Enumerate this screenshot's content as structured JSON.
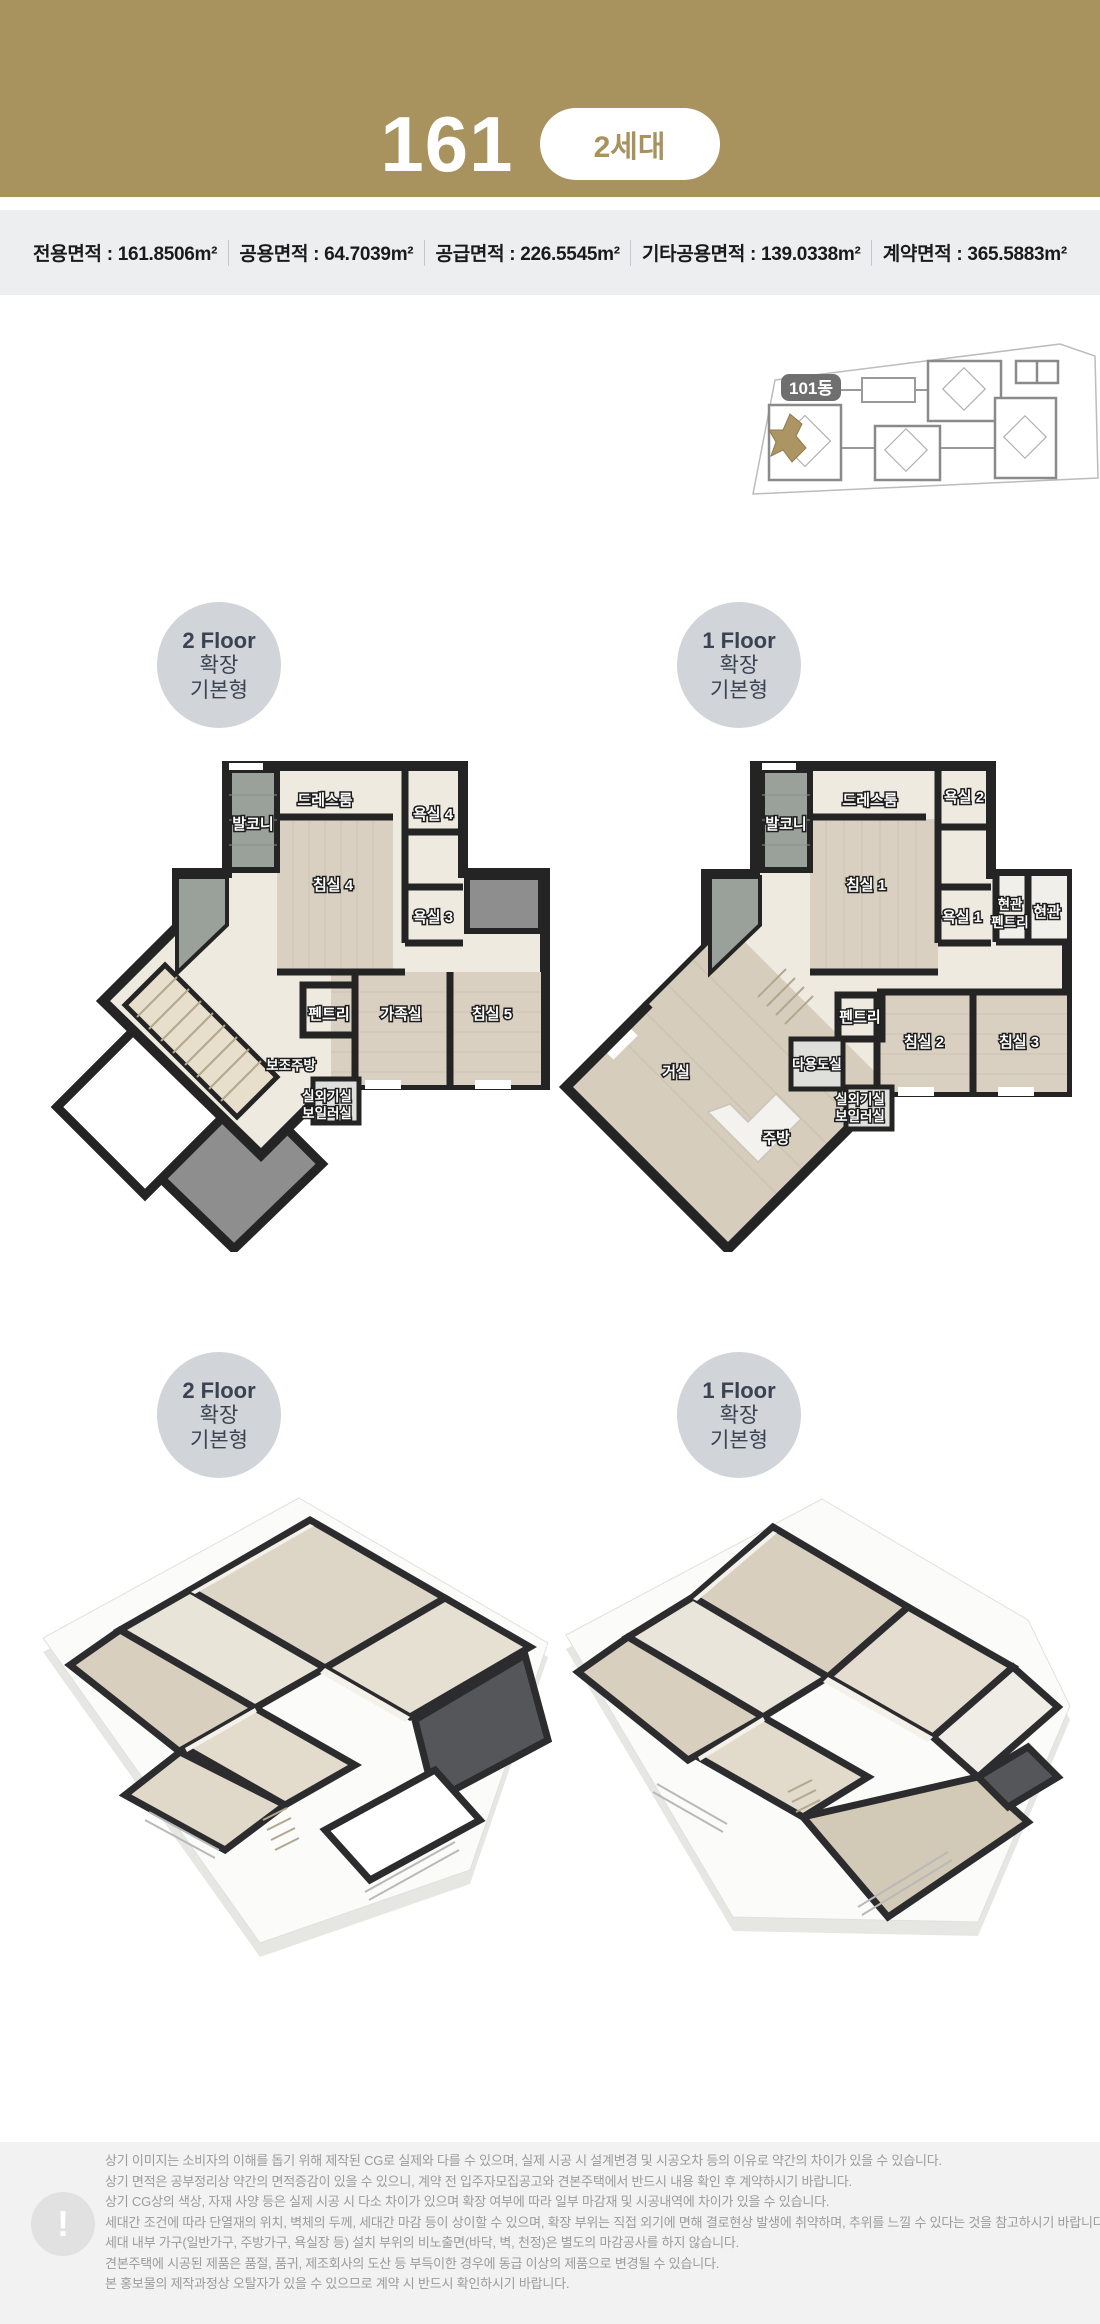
{
  "header": {
    "unit_number": "161",
    "badge_label": "2세대"
  },
  "area_bar": {
    "items": [
      "전용면적 : 161.8506m²",
      "공용면적 : 64.7039m²",
      "공급면적 : 226.5545m²",
      "기타공용면적 : 139.0338m²",
      "계약면적 : 365.5883m²"
    ]
  },
  "site_plan": {
    "building_label": "101동",
    "highlight_color": "#ac9563"
  },
  "badges": {
    "floor2": [
      "2 Floor",
      "확장",
      "기본형"
    ],
    "floor1": [
      "1 Floor",
      "확장",
      "기본형"
    ]
  },
  "floor2_plan": {
    "rooms": {
      "dressroom": "드레스룸",
      "balcony": "발코니",
      "bath4": "욕실 4",
      "bed4": "침실 4",
      "bath3": "욕실 3",
      "pantry": "펜트리",
      "family": "가족실",
      "bed5": "침실 5",
      "subkitchen": "보조주방",
      "outdoor_unit": "실외기실",
      "boiler": "보일러실"
    }
  },
  "floor1_plan": {
    "rooms": {
      "balcony": "발코니",
      "dressroom": "드레스룸",
      "bath2": "욕실 2",
      "bed1": "침실 1",
      "bath1": "욕실 1",
      "entry_pantry_line1": "현관",
      "entry_pantry_line2": "펜트리",
      "entry": "현관",
      "pantry": "펜트리",
      "bed2": "침실 2",
      "bed3": "침실 3",
      "utility": "다용도실",
      "living": "거실",
      "outdoor_unit": "실외기실",
      "boiler": "보일러실",
      "kitchen": "주방"
    }
  },
  "disclaimer": {
    "icon": "!",
    "lines": [
      "상기 이미지는 소비자의 이해를 돕기 위해 제작된 CG로 실제와 다를 수 있으며, 실제 시공 시 설계변경 및 시공오차 등의 이유로 약간의 차이가 있을 수 있습니다.",
      "상기 면적은 공부정리상 약간의 면적증감이 있을 수 있으니, 계약 전 입주자모집공고와 견본주택에서 반드시 내용 확인 후 계약하시기 바랍니다.",
      "상기 CG상의 색상, 자재 사양 등은 실제 시공 시 다소 차이가 있으며 확장 여부에 따라 일부 마감재 및 시공내역에 차이가 있을 수 있습니다.",
      "세대간 조건에 따라 단열재의 위치, 벽체의 두께, 세대간 마감 등이 상이할 수 있으며, 확장 부위는 직접 외기에 면해 결로현상 발생에 취약하며, 추위를 느낄 수 있다는 것을 참고하시기 바랍니다.",
      "세대 내부 가구(일반가구, 주방가구, 욕실장 등) 설치 부위의 비노출면(바닥, 벽, 천정)은 별도의 마감공사를 하지 않습니다.",
      "견본주택에 시공된 제품은 품절, 품귀, 제조회사의 도산 등 부득이한 경우에 동급 이상의 제품으로 변경될 수 있습니다.",
      "본 홍보물의 제작과정상 오탈자가 있을 수 있으므로 계약 시 반드시 확인하시기 바랍니다."
    ]
  }
}
